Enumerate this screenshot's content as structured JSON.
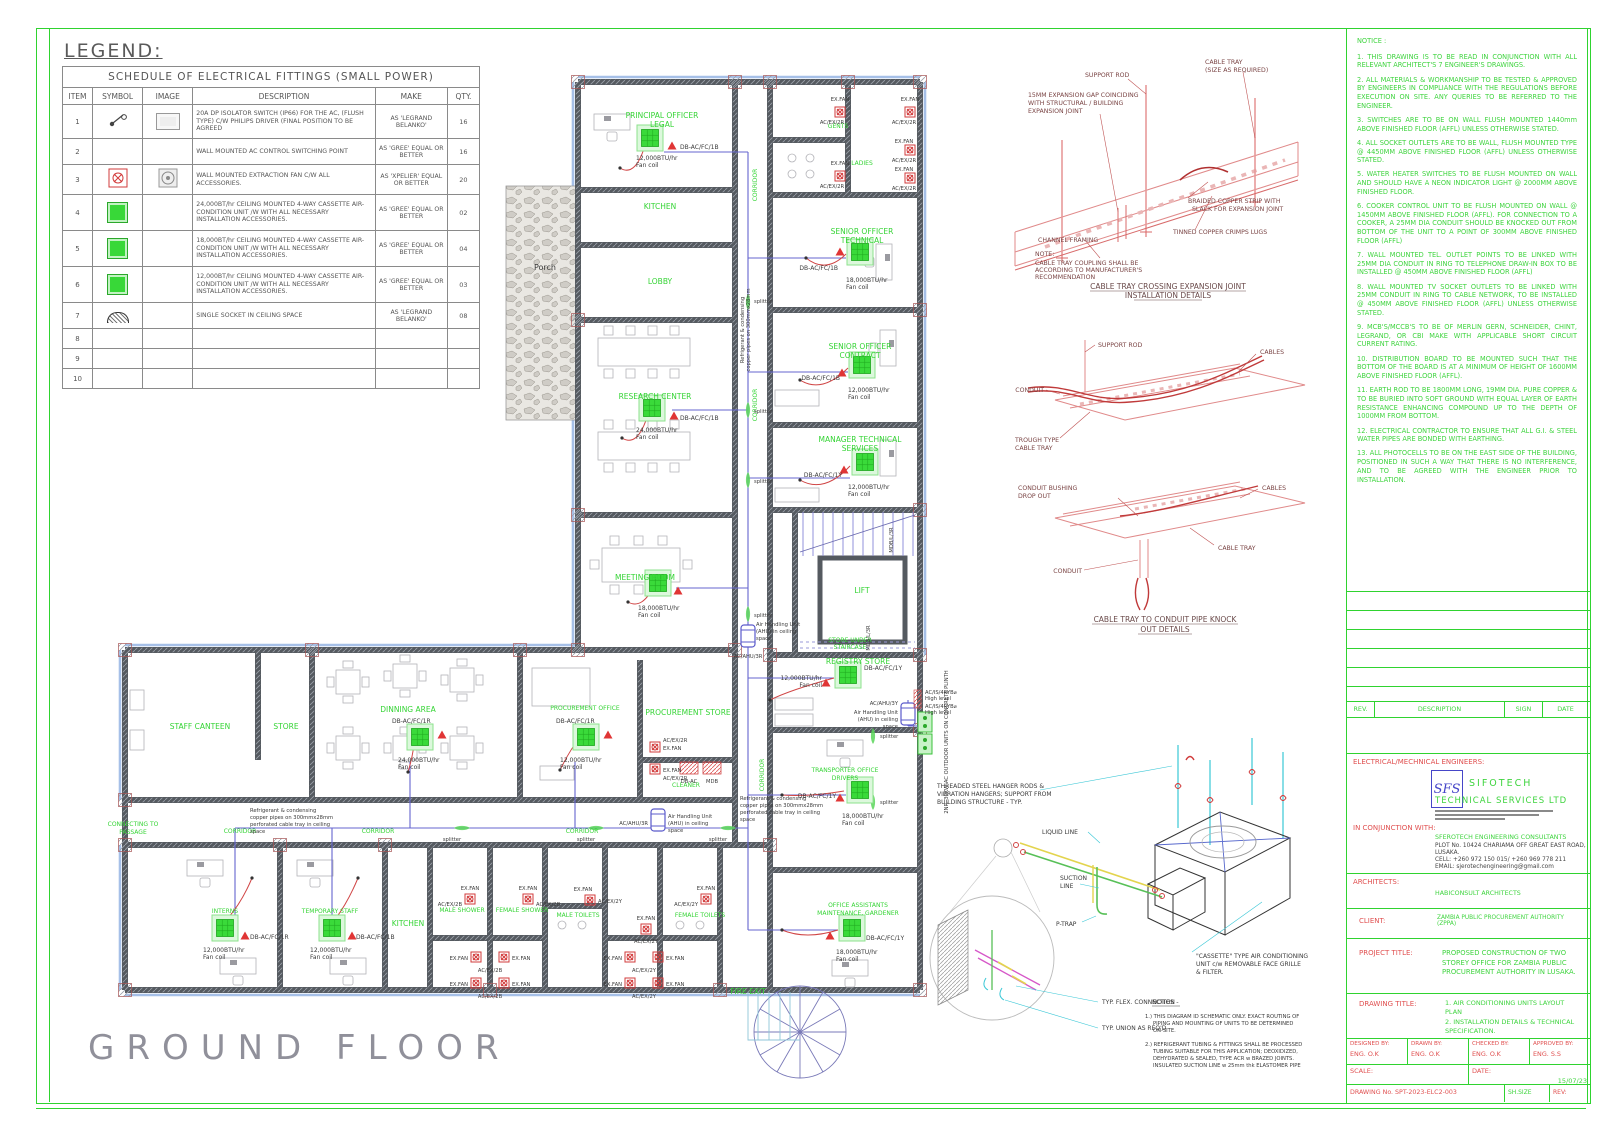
{
  "legend": {
    "title": "LEGEND:",
    "table_title": "SCHEDULE OF ELECTRICAL FITTINGS (SMALL POWER)",
    "headers": [
      "ITEM",
      "SYMBOL",
      "IMAGE",
      "DESCRIPTION",
      "MAKE",
      "QTY."
    ],
    "rows": [
      {
        "item": "1",
        "description": "20A DP ISOLATOR SWITCH (IP66) FOR THE AC, (FLUSH TYPE) C/W PHILIPS DRIVER (FINAL POSITION TO BE AGREED",
        "make": "AS 'LEGRAND BELANKO'",
        "qty": "16"
      },
      {
        "item": "2",
        "description": "WALL MOUNTED AC CONTROL SWITCHING POINT",
        "make": "AS 'GREE' EQUAL OR BETTER",
        "qty": "16"
      },
      {
        "item": "3",
        "description": "WALL MOUNTED EXTRACTION FAN C/W ALL ACCESSORIES.",
        "make": "AS 'XPELIER' EQUAL OR BETTER",
        "qty": "20"
      },
      {
        "item": "4",
        "description": "24,000BT/hr CEILING MOUNTED 4-WAY CASSETTE AIR-CONDITION UNIT /W WITH ALL NECESSARY INSTALLATION ACCESSORIES.",
        "make": "AS 'GREE' EQUAL OR BETTER",
        "qty": "02"
      },
      {
        "item": "5",
        "description": "18,000BT/hr CEILING MOUNTED 4-WAY CASSETTE AIR-CONDITION UNIT /W WITH ALL NECESSARY INSTALLATION ACCESSORIES.",
        "make": "AS 'GREE' EQUAL OR BETTER",
        "qty": "04"
      },
      {
        "item": "6",
        "description": "12,000BT/hr CEILING MOUNTED 4-WAY CASSETTE AIR-CONDITION UNIT /W WITH ALL NECESSARY INSTALLATION ACCESSORIES.",
        "make": "AS 'GREE' EQUAL OR BETTER",
        "qty": "03"
      },
      {
        "item": "7",
        "description": "SINGLE SOCKET IN CEILING SPACE",
        "make": "AS 'LEGRAND BELANKO'",
        "qty": "08"
      },
      {
        "item": "8"
      },
      {
        "item": "9"
      },
      {
        "item": "10"
      }
    ]
  },
  "plan": {
    "rooms": {
      "principal": [
        "PRINCIPAL OFFICER",
        "LEGAL"
      ],
      "kitchen_top": "KITCHEN",
      "lobby": "LOBBY",
      "gents": "GENTS",
      "ladies": "LADIES",
      "corridor": "CORRIDOR",
      "senior_technical": [
        "SENIOR OFFICER",
        "TECHNICAL"
      ],
      "research": "RESEARCH CENTER",
      "senior_contract": [
        "SENIOR OFFICER",
        "CONTRACT"
      ],
      "manager_technical": [
        "MANAGER TECHNICAL",
        "SERVICES"
      ],
      "meeting": "MEETING ROOM",
      "lift": "LIFT",
      "store_under_stair": [
        "STORE UNDER",
        "STAIRCASE"
      ],
      "registry": "REGISTRY STORE",
      "transporter": [
        "TRANSPORTER OFFICE",
        "DRIVERS"
      ],
      "office_assistants": [
        "OFFICE ASSISTANTS",
        "MAINTENANCE, GARDENER"
      ],
      "staff_canteen": "STAFF CANTEEN",
      "store": "STORE",
      "dinning": "DINNING AREA",
      "procurement_office": "PROCUREMENT OFFICE",
      "procurement_store": "PROCUREMENT STORE",
      "cleaner": "CLEANER",
      "connecting": [
        "CONNECTING TO",
        "PASSAGE"
      ],
      "interns": "INTERNS",
      "temp_staff": "TEMPORARY STAFF",
      "kitchen_bottom": "KITCHEN",
      "male_shower": "MALE SHOWER",
      "female_shower": "FEMALE SHOWER",
      "male_toilets": "MALE TOILETS",
      "female_toilets": "FEMALE TOILETS",
      "fire_exit": "FIRE EXIT",
      "porch": "Porch"
    },
    "tags": {
      "exfan": "EX.FAN",
      "ex2r": "AC/EX/2R",
      "ex2b": "AC/EX/2B",
      "ex2y": "AC/EX/2Y",
      "db1b": "DB-AC/FC/1B",
      "db1y": "DB-AC/FC/1Y",
      "db1r": "DB-AC/FC/1R",
      "b12": "12,000BTU/hr",
      "b18": "18,000BTU/hr",
      "b24": "24,000BTU/hr",
      "fan_coil": "Fan coil",
      "splitter": "splitter",
      "ahu1": "Air Handling Unit",
      "ahu2": "(AHU) in ceiling",
      "ahu3": "space",
      "ahu3r": "AC/AHU/3R",
      "ahu3y": "AC/AHU/3Y",
      "ref1": "Refrigerant & condensing",
      "ref2": "copper pipes on 300mmx28mm",
      "ref3": "perforated cable tray in ceiling",
      "ref4": "space",
      "hl1": "AC/IS/4RYB⌀",
      "hl2": "High level",
      "odu": "2NR. 30KW AC OUTDOOR UNITS ON CONCRETE PLINTH",
      "mdb_l": "MDB/L/3R",
      "dbac": "DB-AC",
      "mdb": "MDB"
    }
  },
  "detail1": {
    "support_rod": "SUPPORT ROD",
    "cable_tray_1": "CABLE TRAY",
    "cable_tray_2": "(SIZE AS REQUIRED)",
    "gap1": "15MM EXPANSION GAP COINCIDING",
    "gap2": "WITH STRUCTURAL / BUILDING",
    "gap3": "EXPANSION JOINT",
    "braid1": "BRAIDED COPPER STRIP WITH",
    "braid2": "SLACK FOR EXPANSION JOINT",
    "lugs": "TINNED COPPER CRIMPS LUGS",
    "channel": "CHANNEL FRAMING",
    "note_t": "NOTE:",
    "note1": "CABLE TRAY COUPLING SHALL BE",
    "note2": "ACCORDING TO MANUFACTURER'S",
    "note3": "RECOMMENDATION",
    "title1": "CABLE TRAY CROSSING EXPANSION JOINT",
    "title2": "INSTALLATION DETAILS"
  },
  "detail2": {
    "support_rod": "SUPPORT ROD",
    "cables": "CABLES",
    "conduit": "CONDUIT",
    "trough1": "TROUGH TYPE",
    "trough2": "CABLE TRAY",
    "bush1": "CONDUIT BUSHING",
    "bush2": "DROP OUT",
    "cable_tray": "CABLE TRAY",
    "title1": "CABLE TRAY TO CONDUIT PIPE KNOCK",
    "title2": "OUT DETAILS"
  },
  "detail3": {
    "hanger1": "THREADED STEEL HANGER RODS &",
    "hanger2": "VIBRATION HANGERS; SUPPORT FROM",
    "hanger3": "BUILDING STRUCTURE - TYP.",
    "liquid": "LIQUID LINE",
    "suction1": "SUCTION",
    "suction2": "LINE",
    "ptrap": "P-TRAP",
    "cassette1": "\"CASSETTE\" TYPE AIR CONDITIONING",
    "cassette2": "UNIT c/w REMOVABLE FACE GRILLE",
    "cassette3": "& FILTER.",
    "flex": "TYP. FLEX. CONNECTION",
    "union": "TYP. UNION AS REQ'D",
    "notes_t": "NOTES -",
    "n1a": "1.) THIS DIAGRAM ID SCHEMATIC ONLY. EXACT ROUTING OF",
    "n1b": "PIPING AND MOUNTING OF UNITS TO BE DETERMINED",
    "n1c": "ON-SITE.",
    "n2a": "2.) REFRIGERANT TUBING & FITTINGS SHALL BE PROCESSED",
    "n2b": "TUBING SUITABLE FOR THIS APPLICATION; DEOXIDIZED,",
    "n2c": "DEHYDRATED & SEALED, TYPE ACR w BRAZED JOINTS.",
    "n2d": "INSULATED SUCTION LINE w 25mm thk ELASTOMER PIPE"
  },
  "notice": {
    "title": "NOTICE :",
    "items": [
      "1. THIS DRAWING IS TO BE READ IN CONJUNCTION WITH ALL RELEVANT ARCHITECT'S 7 ENGINEER'S DRAWINGS.",
      "2. ALL MATERIALS & WORKMANSHIP TO BE TESTED & APPROVED BY ENGINEERS IN COMPLIANCE WITH THE REGULATIONS BEFORE EXECUTION ON SITE. ANY QUERIES TO BE REFERRED TO THE ENGINEER.",
      "3. SWITCHES ARE TO BE ON WALL FLUSH MOUNTED 1440mm ABOVE FINISHED FLOOR (AFFL) UNLESS OTHERWISE STATED.",
      "4. ALL SOCKET OUTLETS ARE TO BE WALL, FLUSH MOUNTED TYPE @ 4450MM ABOVE FINISHED FLOOR (AFFL) UNLESS OTHERWISE STATED.",
      "5. WATER HEATER SWITCHES TO BE FLUSH MOUNTED ON WALL AND SHOULD HAVE A NEON INDICATOR LIGHT @ 2000MM ABOVE FINISHED FLOOR.",
      "6. COOKER CONTROL UNIT TO BE FLUSH MOUNTED ON WALL @ 1450MM ABOVE FINISHED FLOOR (AFFL). FOR CONNECTION TO A COOKER, A 25MM DIA CONDUIT SHOULD BE KNOCKED OUT FROM BOTTOM OF THE UNIT TO A POINT OF 300MM ABOVE FINISHED FLOOR (AFFL)",
      "7. WALL MOUNTED TEL. OUTLET POINTS TO BE LINKED WITH 25MM DIA CONDUIT IN RING TO TELEPHONE DRAW-IN BOX TO BE INSTALLED @ 450MM ABOVE FINISHED FLOOR (AFFL)",
      "8. WALL MOUNTED TV SOCKET OUTLETS TO BE LINKED WITH 25MM CONDUIT IN RING TO CABLE NETWORK, TO BE INSTALLED @ 450MM ABOVE FINISHED FLOOR (AFFL) UNLESS OTHERWISE STATED.",
      "9. MCB'S/MCCB'S TO BE OF MERLIN GERN, SCHNEIDER, CHINT, LEGRAND, OR CBI MAKE WITH APPLICABLE SHORT CIRCUIT CURRENT RATING.",
      "10. DISTRIBUTION BOARD TO BE MOUNTED SUCH THAT THE BOTTOM OF THE BOARD IS AT A MINIMUM OF HEIGHT OF 1600MM ABOVE FINISHED FLOOR (AFFL).",
      "11. EARTH ROD TO BE 1800MM LONG, 19MM DIA. PURE COPPER & TO BE BURIED INTO SOFT GROUND WITH EQUAL LAYER OF EARTH RESISTANCE ENHANCING COMPOUND UP TO THE DEPTH OF 1000MM FROM BOTTOM.",
      "12. ELECTRICAL CONTRACTOR TO ENSURE THAT ALL G.I. & STEEL WATER PIPES ARE BONDED WITH EARTHING.",
      "13. ALL PHOTOCELLS TO BE ON THE EAST SIDE OF THE BUILDING, POSITIONED IN SUCH A WAY THAT THERE IS NO INTERFERENCE, AND TO BE AGREED WITH THE ENGINEER PRIOR TO INSTALLATION."
    ]
  },
  "title_block": {
    "rev_header": {
      "rev": "REV.",
      "description": "DESCRIPTION",
      "sign": "SIGN",
      "date": "DATE"
    },
    "engineers": {
      "label": "ELECTRICAL/MECHNICAL ENGINEERS:",
      "logo": "SFS",
      "name_line1": "SIFOTECH",
      "name_line2": "TECHNICAL SERVICES LTD",
      "conjunction_label": "IN CONJUNCTION WITH:",
      "consultant": "SFEROTECH ENGINEERING CONSULTANTS",
      "address1": "PLOT No. 10424 CHARIAMA OFF GREAT EAST ROAD,",
      "address2": "LUSAKA.",
      "cell": "CELL: +260 972 150 015/ +260 969 778 211",
      "email": "EMAIL: sjerotechengineering@gmail.com"
    },
    "architects_label": "ARCHITECTS:",
    "architects_value": "HABICONSULT ARCHITECTS",
    "client_label": "CLIENT:",
    "client_value": "ZAMBIA PUBLIC PROCUREMENT AUTHORITY (ZPPA)",
    "project_label": "PROJECT TITLE:",
    "project_value": "PROPOSED CONSTRUCTION OF TWO STOREY OFFICE FOR ZAMBIA PUBLIC PROCUREMENT AUTHORITY IN LUSAKA.",
    "drawing_label": "DRAWING TITLE:",
    "drawing_value1": "1. AIR CONDITIONING UNITS LAYOUT PLAN",
    "drawing_value2": "2. INSTALLATION DETAILS & TECHNICAL SPECIFICATION.",
    "designed_label": "DESIGNED BY:",
    "designed_value": "ENG. O.K",
    "drawn_label": "DRAWN BY:",
    "drawn_value": "ENG. O.K",
    "checked_label": "CHECKED BY:",
    "checked_value": "ENG. O.K",
    "approved_label": "APPROVED BY:",
    "approved_value": "ENG. S.S",
    "scale_label": "SCALE:",
    "date_label": "DATE:",
    "date_value": "15/07/23",
    "drawing_no": "DRAWING No. SPT-2023-ELC2-003",
    "sh_size": "SH.SIZE",
    "rev": "REV:"
  },
  "ground_floor": "GROUND FLOOR"
}
